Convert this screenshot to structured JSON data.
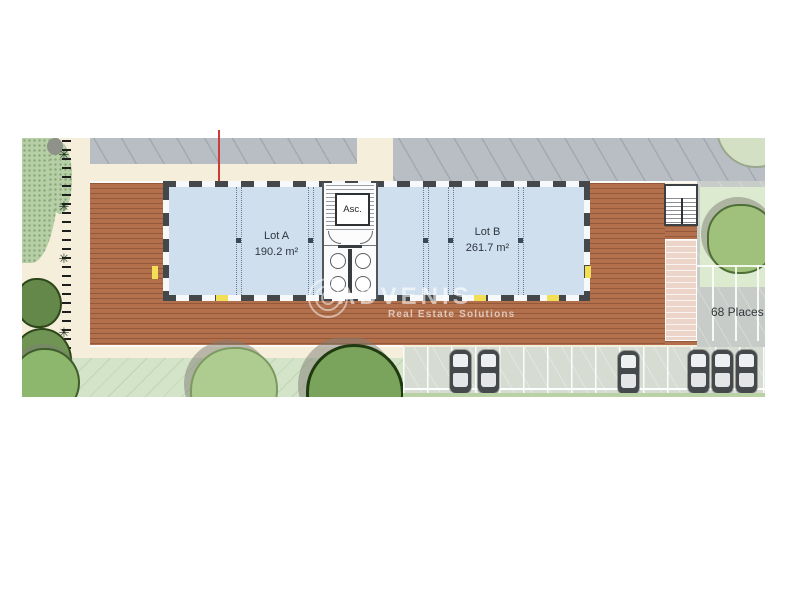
{
  "plan": {
    "lots": [
      {
        "name": "Lot A",
        "area": "190.2 m²"
      },
      {
        "name": "Lot B",
        "area": "261.7 m²"
      }
    ],
    "elevator_label": "Asc.",
    "parking_label": "68 Places"
  },
  "watermark": {
    "brand": "ADVENIS",
    "tagline": "Real Estate Solutions"
  },
  "icons": {
    "plant_glyph": "✳"
  },
  "colors": {
    "deck": "#b2704c",
    "interior": "#cfdfee",
    "wall": "#44484b",
    "road": "#b9bec4",
    "grass": "#d3e4c8",
    "beige": "#f4eedb",
    "parking": "#d6dcd2",
    "parking_dark": "#c8ccc8",
    "accent_red": "#cc3b35",
    "highlight_yellow": "#f3df56"
  }
}
